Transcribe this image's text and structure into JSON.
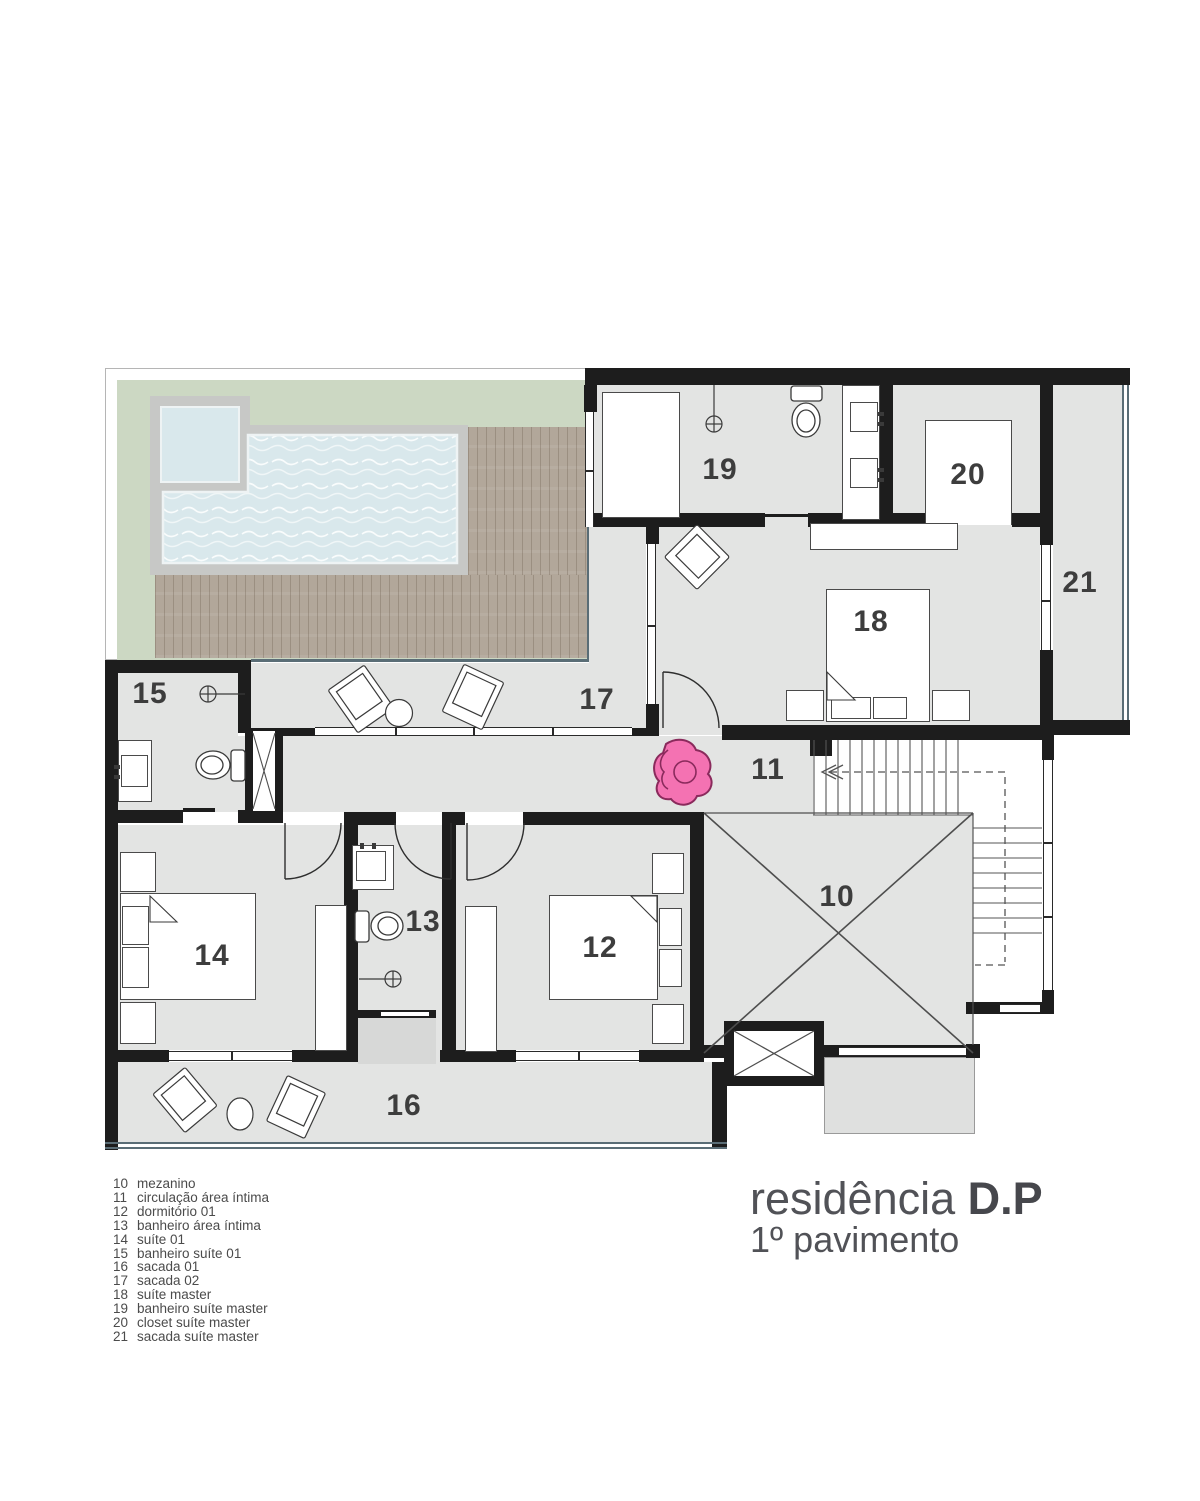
{
  "title": {
    "name": "residência",
    "emphasis": "D.P",
    "subtitle": "1º pavimento"
  },
  "legend": {
    "items": [
      {
        "num": "10",
        "name": "mezanino"
      },
      {
        "num": "11",
        "name": "circulação área íntima"
      },
      {
        "num": "12",
        "name": "dormitório 01"
      },
      {
        "num": "13",
        "name": "banheiro área íntima"
      },
      {
        "num": "14",
        "name": "suíte 01"
      },
      {
        "num": "15",
        "name": "banheiro suíte 01"
      },
      {
        "num": "16",
        "name": "sacada 01"
      },
      {
        "num": "17",
        "name": "sacada 02"
      },
      {
        "num": "18",
        "name": "suíte master"
      },
      {
        "num": "19",
        "name": "banheiro suíte master"
      },
      {
        "num": "20",
        "name": "closet suíte master"
      },
      {
        "num": "21",
        "name": "sacada suíte master"
      }
    ]
  },
  "colors": {
    "wall": "#1d1d1d",
    "floor": "#e3e4e3",
    "lawn": "#ccd8c3",
    "water": "#d9e8ec",
    "deck": "#b2a79a",
    "coping": "#c7c8c6",
    "edge": "#5a6d76",
    "person": "#f472b2",
    "person_outline": "#8a2a5c",
    "label": "#3d3d3d",
    "line": "#4a4a4a"
  }
}
